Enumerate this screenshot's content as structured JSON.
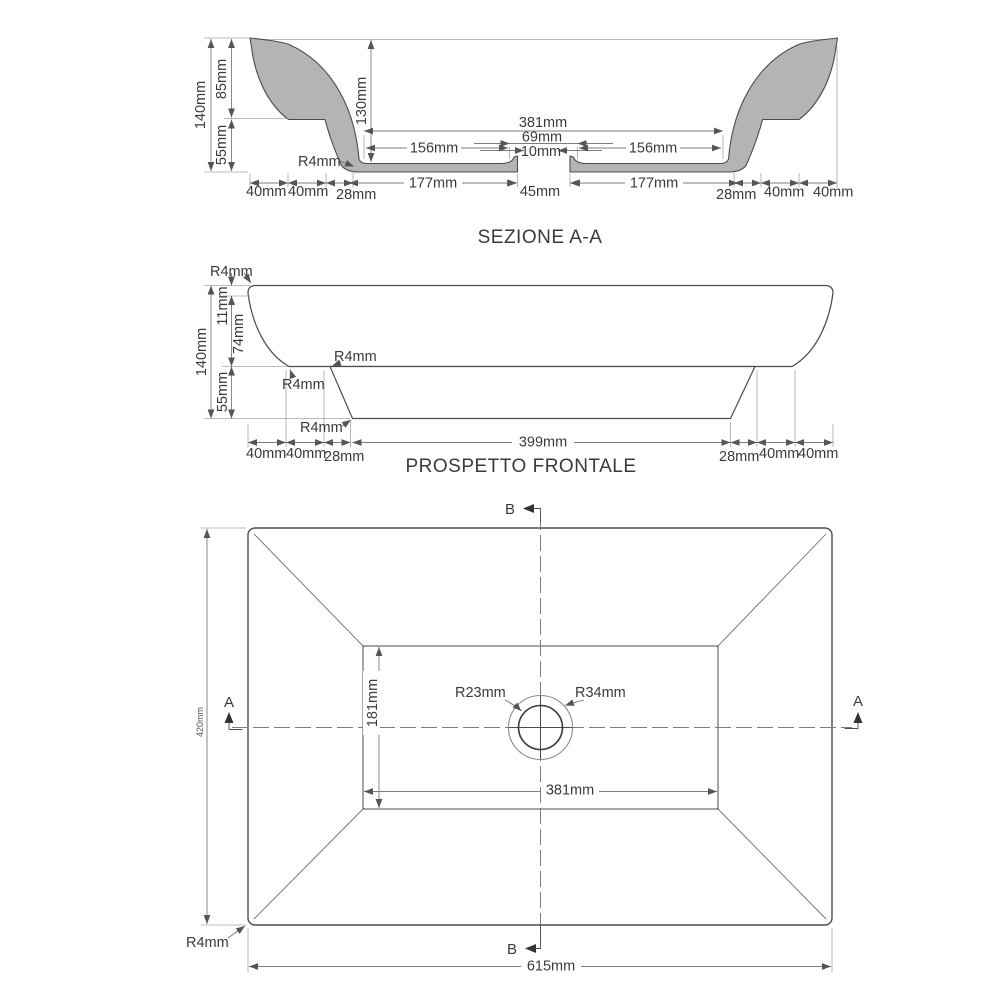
{
  "drawing": {
    "colors": {
      "background": "#ffffff",
      "outline": "#4d4d4d",
      "profile_fill": "#b4b4b4",
      "dimension_lines": "#7d7d7d",
      "text": "#3a3a3a"
    },
    "section": {
      "title": "SEZIONE A-A",
      "dim_140": "140mm",
      "dim_85": "85mm",
      "dim_55": "55mm",
      "dim_130": "130mm",
      "radius_r4": "R4mm",
      "dim_381": "381mm",
      "dim_69": "69mm",
      "dim_10": "10mm",
      "dim_45": "45mm",
      "dim_156_left": "156mm",
      "dim_156_right": "156mm",
      "dim_177_left": "177mm",
      "dim_177_right": "177mm",
      "bottom_left_40_a": "40mm",
      "bottom_left_40_b": "40mm",
      "bottom_left_28": "28mm",
      "bottom_right_28": "28mm",
      "bottom_right_40_a": "40mm",
      "bottom_right_40_b": "40mm"
    },
    "front": {
      "title": "PROSPETTO FRONTALE",
      "dim_11": "11mm",
      "dim_74": "74mm",
      "dim_140": "140mm",
      "dim_55": "55mm",
      "radius_top": "R4mm",
      "radius_ledge": "R4mm",
      "radius_corner": "R4mm",
      "radius_bottom": "R4mm",
      "dim_399": "399mm",
      "bottom_left_40_a": "40mm",
      "bottom_left_40_b": "40mm",
      "bottom_left_28": "28mm",
      "bottom_right_28": "28mm",
      "bottom_right_40_a": "40mm",
      "bottom_right_40_b": "40mm"
    },
    "plan": {
      "section_marker_a_left": "A",
      "section_marker_a_right": "A",
      "section_marker_b_top": "B",
      "section_marker_b_bottom": "B",
      "dim_420": "420mm",
      "dim_615": "615mm",
      "dim_381": "381mm",
      "dim_181": "181mm",
      "radius_inner": "R23mm",
      "radius_outer": "R34mm",
      "radius_corner": "R4mm"
    }
  }
}
